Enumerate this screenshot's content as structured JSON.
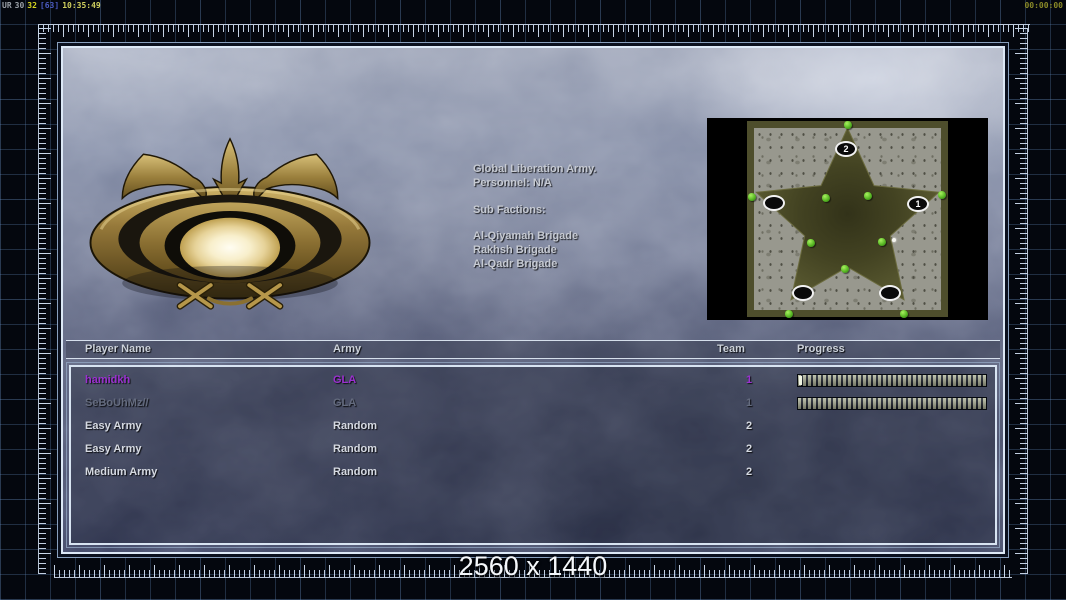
{
  "hud": {
    "debug_segments": [
      {
        "text": "UR",
        "color": "#9aa0a8"
      },
      {
        "text": "30",
        "color": "#9aa0a8"
      },
      {
        "text": "32",
        "color": "#d8d820"
      },
      {
        "text": "[63]",
        "color": "#4a5ac0"
      },
      {
        "text": "10:35:49",
        "color": "#cfcf5e"
      }
    ],
    "match_timer": "00:00:00"
  },
  "faction": {
    "name": "Global Liberation Army.",
    "personnel": "Personnel: N/A",
    "sub_factions_label": "Sub Factions:",
    "sub_factions": [
      "Al-Qiyamah Brigade",
      "Rakhsh Brigade",
      "Al-Qadr Brigade"
    ]
  },
  "map_preview": {
    "shape": "five-point-star",
    "markers": [
      {
        "label": "2"
      },
      {
        "label": "1"
      },
      {
        "label": ""
      },
      {
        "label": ""
      },
      {
        "label": ""
      }
    ],
    "colors": {
      "star": "#4e4e2c",
      "stone": "#98988e",
      "background": "#000000",
      "tree": "#58b824"
    }
  },
  "player_table": {
    "columns": {
      "name": "Player Name",
      "army": "Army",
      "team": "Team",
      "progress": "Progress"
    },
    "rows": [
      {
        "name": "hamidkh",
        "army": "GLA",
        "team": "1",
        "color": "#9b30d0",
        "loading": true
      },
      {
        "name": "SeBoUhMz//",
        "army": "GLA",
        "team": "1",
        "color": "#646b7e",
        "loading": true
      },
      {
        "name": "Easy Army",
        "army": "Random",
        "team": "2",
        "color": "#d6dae2",
        "loading": false
      },
      {
        "name": "Easy Army",
        "army": "Random",
        "team": "2",
        "color": "#d6dae2",
        "loading": false
      },
      {
        "name": "Medium Army",
        "army": "Random",
        "team": "2",
        "color": "#d6dae2",
        "loading": false
      }
    ]
  },
  "footer": {
    "resolution": "2560 x 1440"
  }
}
